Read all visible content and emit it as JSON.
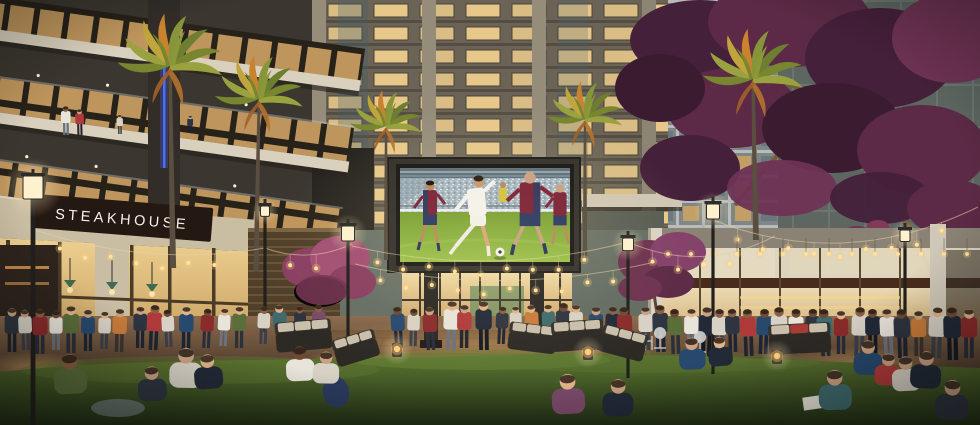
{
  "meta": {
    "type": "architectural-rendering",
    "setting": "Evening plaza between high-rise residential towers with restaurants, outdoor LED screen and event lawn",
    "time_of_day": "dusk"
  },
  "signs": {
    "steakhouse": "STEAKHOUSE"
  },
  "screen": {
    "content": "soccer-match",
    "detail": "Player in white kit kicking the ball between defenders in dark red and blue kits, stadium crowd behind"
  },
  "colors": {
    "sky_top": "#76828c",
    "warm_window": "#e8c88a",
    "screen_pitch": "#8fb944",
    "jacaranda": "#5c2a46",
    "lawn": "#44571f",
    "bulb": "#ffe3a1",
    "led_accent_blue": "#4a6cff",
    "sign_board": "#241812"
  },
  "crowd": {
    "skins": [
      "#caa183",
      "#8a5f43",
      "#e0b38a",
      "#6e4a33"
    ],
    "palette": [
      [
        "#2e3440",
        "#1f2430"
      ],
      [
        "#8a2b2b",
        "#2a2d3a"
      ],
      [
        "#d8d2c6",
        "#3a3f4a"
      ],
      [
        "#5a6e3a",
        "#2c3038"
      ],
      [
        "#27496d",
        "#1c2535"
      ],
      [
        "#c87c3a",
        "#3a3330"
      ],
      [
        "#7a4a6a",
        "#2a2535"
      ],
      [
        "#e8e4da",
        "#6b7280"
      ],
      [
        "#b03a3a",
        "#20242e"
      ],
      [
        "#3f6b6e",
        "#262b33"
      ],
      [
        "#222a38",
        "#141a24"
      ],
      [
        "#caa83a",
        "#33302a"
      ]
    ],
    "standing": [
      [
        66,
        135,
        30,
        7
      ],
      [
        80,
        135,
        27,
        8
      ],
      [
        120,
        134,
        20,
        2
      ],
      [
        190,
        133,
        18,
        0
      ],
      [
        12,
        352,
        46,
        0
      ],
      [
        26,
        350,
        42,
        2
      ],
      [
        40,
        354,
        47,
        1
      ],
      [
        56,
        350,
        41,
        7
      ],
      [
        71,
        353,
        49,
        3
      ],
      [
        88,
        351,
        43,
        4
      ],
      [
        104,
        349,
        39,
        2
      ],
      [
        119,
        352,
        45,
        5
      ],
      [
        140,
        348,
        43,
        0
      ],
      [
        153,
        350,
        47,
        8
      ],
      [
        169,
        347,
        39,
        2
      ],
      [
        186,
        350,
        45,
        4
      ],
      [
        206,
        348,
        41,
        1
      ],
      [
        223,
        346,
        39,
        7
      ],
      [
        239,
        348,
        43,
        3
      ],
      [
        263,
        344,
        39,
        2
      ],
      [
        281,
        346,
        43,
        9
      ],
      [
        301,
        342,
        37,
        0
      ],
      [
        319,
        344,
        41,
        6
      ],
      [
        399,
        348,
        43,
        4
      ],
      [
        413,
        346,
        39,
        2
      ],
      [
        431,
        350,
        45,
        1
      ],
      [
        451,
        350,
        51,
        7
      ],
      [
        464,
        348,
        45,
        8
      ],
      [
        484,
        350,
        51,
        10
      ],
      [
        501,
        344,
        39,
        0
      ],
      [
        516,
        342,
        37,
        2
      ],
      [
        533,
        346,
        43,
        5
      ],
      [
        549,
        344,
        41,
        9
      ],
      [
        563,
        348,
        47,
        0
      ],
      [
        576,
        346,
        43,
        2
      ],
      [
        596,
        350,
        45,
        4
      ],
      [
        611,
        348,
        43,
        10
      ],
      [
        626,
        352,
        47,
        1
      ],
      [
        646,
        350,
        45,
        2
      ],
      [
        661,
        352,
        49,
        0
      ],
      [
        676,
        354,
        47,
        3
      ],
      [
        691,
        352,
        45,
        7
      ],
      [
        706,
        356,
        51,
        10
      ],
      [
        719,
        354,
        47,
        2
      ],
      [
        733,
        352,
        45,
        0
      ],
      [
        749,
        356,
        49,
        8
      ],
      [
        763,
        354,
        47,
        4
      ],
      [
        779,
        356,
        51,
        2
      ],
      [
        796,
        354,
        47,
        7
      ],
      [
        811,
        352,
        45,
        0
      ],
      [
        826,
        356,
        49,
        9
      ],
      [
        841,
        354,
        45,
        1
      ],
      [
        859,
        356,
        51,
        2
      ],
      [
        873,
        354,
        47,
        10
      ],
      [
        889,
        356,
        49,
        7
      ],
      [
        903,
        358,
        51,
        0
      ],
      [
        919,
        356,
        47,
        5
      ],
      [
        936,
        358,
        53,
        2
      ],
      [
        953,
        360,
        55,
        10
      ],
      [
        969,
        358,
        51,
        1
      ]
    ],
    "seated": [
      [
        70,
        372,
        30,
        3
      ],
      [
        152,
        382,
        26,
        0
      ],
      [
        186,
        366,
        30,
        2
      ],
      [
        208,
        370,
        26,
        10
      ],
      [
        300,
        362,
        26,
        7
      ],
      [
        326,
        366,
        24,
        2
      ],
      [
        692,
        352,
        24,
        4
      ],
      [
        720,
        350,
        22,
        10
      ],
      [
        568,
        392,
        30,
        6
      ],
      [
        618,
        396,
        28,
        10
      ],
      [
        835,
        388,
        30,
        9
      ],
      [
        868,
        356,
        26,
        4
      ],
      [
        888,
        368,
        24,
        8
      ],
      [
        906,
        372,
        26,
        2
      ],
      [
        926,
        368,
        28,
        10
      ],
      [
        952,
        398,
        30,
        0
      ]
    ]
  },
  "string_lights": {
    "spacing": 26,
    "strands": [
      [
        35,
        230,
        150,
        268,
        265,
        248
      ],
      [
        265,
        248,
        308,
        264,
        352,
        244
      ],
      [
        352,
        246,
        490,
        278,
        628,
        242
      ],
      [
        355,
        264,
        500,
        298,
        655,
        262
      ],
      [
        628,
        242,
        702,
        274,
        775,
        236
      ],
      [
        713,
        220,
        845,
        272,
        978,
        207
      ]
    ]
  },
  "pendant_lights": {
    "y": 252,
    "x0": 668,
    "x1": 975,
    "step": 23,
    "drop": 14
  },
  "lamps": [
    [
      33,
      176,
      20,
      425
    ],
    [
      265,
      206,
      9,
      332
    ],
    [
      348,
      226,
      13,
      362
    ],
    [
      628,
      238,
      11,
      378
    ],
    [
      713,
      204,
      13,
      374
    ],
    [
      905,
      230,
      10,
      360
    ]
  ],
  "palms": [
    [
      173,
      62,
      1.25,
      268,
      -1
    ],
    [
      256,
      95,
      1.05,
      272,
      1
    ],
    [
      386,
      122,
      0.85,
      260,
      0
    ],
    [
      585,
      115,
      0.9,
      258,
      0
    ],
    [
      756,
      75,
      1.2,
      240,
      -1
    ]
  ],
  "sofas": [
    [
      304,
      340,
      56,
      26,
      -5,
      0
    ],
    [
      357,
      352,
      44,
      24,
      -17,
      0
    ],
    [
      532,
      342,
      48,
      24,
      7,
      0
    ],
    [
      578,
      340,
      52,
      26,
      -4,
      0
    ],
    [
      622,
      347,
      46,
      24,
      15,
      0
    ],
    [
      800,
      343,
      62,
      26,
      -3,
      1
    ]
  ],
  "fire_lanterns": [
    [
      397,
      349
    ],
    [
      588,
      352
    ],
    [
      777,
      356
    ]
  ]
}
